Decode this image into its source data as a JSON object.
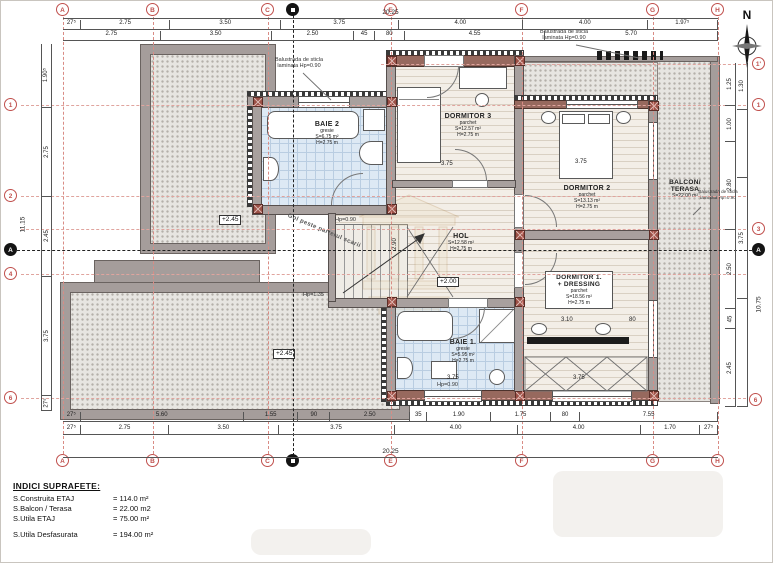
{
  "legend": {
    "title": "INDICI SUPRAFETE:",
    "rows": [
      {
        "label": "S.Construita ETAJ",
        "value": "= 114.0 m²"
      },
      {
        "label": "S.Balcon / Terasa",
        "value": "= 22.00 m2"
      },
      {
        "label": "S.Utila ETAJ",
        "value": "= 75.00 m²"
      },
      {
        "label": "S.Utila Desfasurata",
        "value": "= 194.00 m²"
      }
    ]
  },
  "compass": {
    "label": "N"
  },
  "grid": {
    "cols": [
      {
        "id": "A"
      },
      {
        "id": "B"
      },
      {
        "id": "C"
      },
      {
        "id": "E"
      },
      {
        "id": "F"
      },
      {
        "id": "G"
      },
      {
        "id": "H"
      }
    ],
    "rows_left": [
      {
        "id": "1"
      },
      {
        "id": "2"
      },
      {
        "id": "4"
      },
      {
        "id": "6"
      }
    ],
    "rows_right": [
      {
        "id": "1'"
      },
      {
        "id": "1"
      },
      {
        "id": "3"
      },
      {
        "id": "6"
      }
    ],
    "section_h": {
      "id": "A"
    }
  },
  "dims": {
    "top_overall": "20.25",
    "top_row1": [
      {
        "t": "27⁵",
        "s": 0.275
      },
      {
        "t": "2.75",
        "s": 2.75
      },
      {
        "t": "3.50",
        "s": 3.5
      },
      {
        "t": "3.75",
        "s": 3.75
      },
      {
        "t": "4.00",
        "s": 4
      },
      {
        "t": "4.00",
        "s": 4
      },
      {
        "t": "1.97⁵",
        "s": 1.975
      }
    ],
    "top_row2": [
      {
        "t": "2.75",
        "s": 3.025
      },
      {
        "t": "3.50",
        "s": 3.5
      },
      {
        "t": "2.50",
        "s": 2.5
      },
      {
        "t": "45",
        "s": 0.45
      },
      {
        "t": "80",
        "s": 0.8
      },
      {
        "t": "4.55",
        "s": 4.55
      },
      {
        "t": "5.70",
        "s": 5.7
      }
    ],
    "bottom_row1": [
      {
        "t": "27⁵",
        "s": 0.275
      },
      {
        "t": "5.60",
        "s": 5.6
      },
      {
        "t": "1.55",
        "s": 1.55
      },
      {
        "t": "90",
        "s": 0.9
      },
      {
        "t": "2.50",
        "s": 2.5
      },
      {
        "t": "35",
        "s": 0.35
      },
      {
        "t": "1.90",
        "s": 1.9
      },
      {
        "t": "1.75",
        "s": 1.75
      },
      {
        "t": "80",
        "s": 0.8
      },
      {
        "t": "7.55",
        "s": 4.65
      }
    ],
    "bottom_row2": [
      {
        "t": "27⁵",
        "s": 0.275
      },
      {
        "t": "2.75",
        "s": 2.75
      },
      {
        "t": "3.50",
        "s": 3.5
      },
      {
        "t": "3.75",
        "s": 3.75
      },
      {
        "t": "4.00",
        "s": 4
      },
      {
        "t": "4.00",
        "s": 4
      },
      {
        "t": "1.70",
        "s": 1.7
      },
      {
        "t": "27⁵",
        "s": 0.275
      }
    ],
    "bottom_overall": "20.25",
    "left_col": [
      {
        "t": "1.90⁵",
        "s": 1.905
      },
      {
        "t": "2.75",
        "s": 2.75
      },
      {
        "t": "2.45",
        "s": 2.45
      },
      {
        "t": "3.75",
        "s": 3.75
      },
      {
        "t": "27⁵",
        "s": 0.275
      }
    ],
    "left_overall": "11.15",
    "right_inner": [
      {
        "t": "1.25",
        "s": 1.25
      },
      {
        "t": "1.00",
        "s": 1
      },
      {
        "t": "2.80",
        "s": 2.8
      },
      {
        "t": "2.50",
        "s": 2.5
      },
      {
        "t": "45",
        "s": 0.45
      },
      {
        "t": "2.45",
        "s": 2.45
      }
    ],
    "right_outer": [
      {
        "t": "1.30",
        "s": 1.3
      },
      {
        "t": "",
        "s": 2.2
      },
      {
        "t": "3.75",
        "s": 3.75
      },
      {
        "t": "",
        "s": 3.5
      }
    ],
    "right_overall": "10.75"
  },
  "rooms": {
    "baie2": {
      "name": "BAIE 2",
      "finish": "gresie",
      "area": "S=6.75 m²",
      "height": "H=2.75 m"
    },
    "dormitor3": {
      "name": "DORMITOR 3",
      "finish": "parchet",
      "area": "S=12.57 m²",
      "height": "H=2.75 m"
    },
    "dormitor2": {
      "name": "DORMITOR 2",
      "finish": "parchet",
      "area": "S=13.13 m²",
      "height": "H=2.75 m"
    },
    "hol": {
      "name": "HOL",
      "area": "S=12.58 m²",
      "height": "H=2.75 m"
    },
    "dormitor1": {
      "name": "DORMITOR 1.",
      "name2": "+ DRESSING",
      "finish": "parchet",
      "area": "S=18.56 m²",
      "height": "H=2.75 m"
    },
    "baie1": {
      "name": "BAIE 1.",
      "finish": "gresie",
      "area": "S=5.95 m²",
      "height": "H=2.75 m"
    },
    "balcon": {
      "name": "BALCON/",
      "name2": "TERASA",
      "area": "S=22.00 m²"
    }
  },
  "annotations": {
    "balustrade": "Balustrada de sticla laminata Hp=0.90",
    "gol": "Gol peste parterul scarii",
    "level_terrace_upper": "+2.45",
    "level_hol": "+2.00",
    "level_terrace_lower": "+2.45",
    "hp_stair_top": "Hp=0.90",
    "hp_stair_bottom": "Hp=1.35",
    "hp_baie1": "Hp=0.90"
  },
  "interior_dims": {
    "dorm3": "3.75",
    "dorm2": "3.75",
    "dorm1_a": "3.10",
    "dorm1_b": "80",
    "dorm1_c": "3.75",
    "baie1": "3.75",
    "hol_v": "2.90"
  }
}
